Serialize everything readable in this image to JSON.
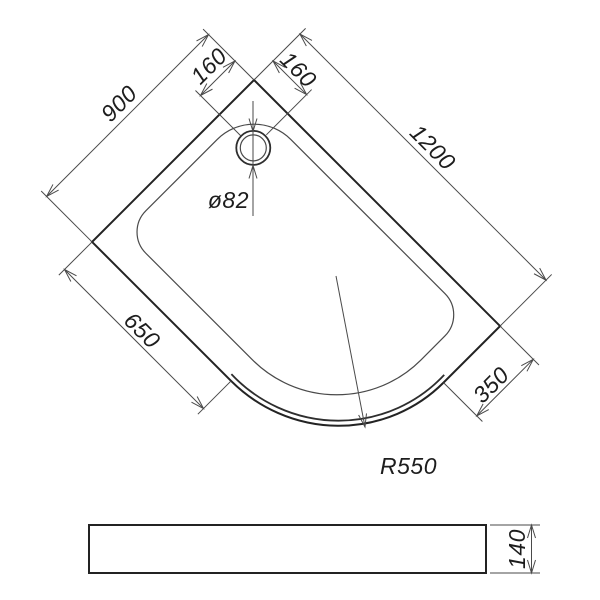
{
  "drawing": {
    "kind": "technical-dimension-drawing",
    "subject": "offset quadrant shower tray",
    "background_color": "#ffffff",
    "main_line_color": "#232323",
    "dimension_line_color": "#4a4a4a",
    "text_color": "#1d1d1d",
    "plan_view": {
      "labels": {
        "side_width": "900",
        "side_length": "1200",
        "drain_offset_left": "160",
        "drain_offset_right": "160",
        "straight_edge_left": "650",
        "straight_edge_right": "350",
        "front_corner_radius": "R550",
        "drain_diameter": "ø82"
      }
    },
    "side_view": {
      "labels": {
        "tray_height": "140"
      }
    }
  }
}
